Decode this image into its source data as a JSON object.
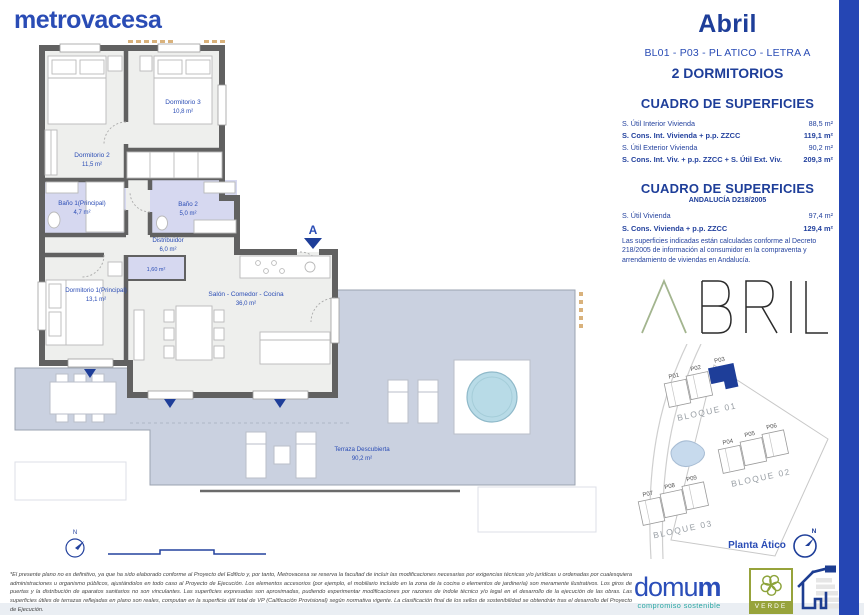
{
  "page": {
    "brand_logo": "metrovacesa",
    "title": "Abril",
    "unit_code": "BL01 - P03 - PL ATICO - LETRA A",
    "typology": "2 DORMITORIOS"
  },
  "surface_table": {
    "title": "CUADRO DE SUPERFICIES",
    "rows": [
      {
        "label": "S. Útil Interior Vivienda",
        "value": "88,5 m²"
      },
      {
        "label": "S. Cons. Int. Vivienda + p.p. ZZCC",
        "value": "119,1 m²"
      },
      {
        "label": "S. Útil Exterior Vivienda",
        "value": "90,2 m²"
      },
      {
        "label": "S. Cons. Int. Viv. + p.p. ZZCC + S. Útil Ext. Viv.",
        "value": "209,3 m²"
      }
    ]
  },
  "andalucia_table": {
    "title": "CUADRO DE SUPERFICIES",
    "subtitle": "ANDALUCÍA D218/2005",
    "rows": [
      {
        "label": "S. Útil Vivienda",
        "value": "97,4 m²"
      },
      {
        "label": "S. Cons. Vivienda + p.p. ZZCC",
        "value": "129,4 m²"
      }
    ],
    "note": "Las superficies indicadas están calculadas conforme al Decreto 218/2005 de información al consumidor en la compraventa y arrendamiento de viviendas en Andalucía."
  },
  "floorplan": {
    "north_label": "N",
    "section_label": "A",
    "rooms": {
      "dorm3": {
        "name": "Dormitorio 3",
        "area": "10,8 m²"
      },
      "dorm2": {
        "name": "Dormitorio 2",
        "area": "11,5 m²"
      },
      "bath1": {
        "name": "Baño 1(Principal)",
        "area": "4,7 m²"
      },
      "bath2": {
        "name": "Baño 2",
        "area": "5,0 m²"
      },
      "hall": {
        "name": "Distribuidor",
        "area": "6,0 m²"
      },
      "closet": {
        "area": "1,60 m²"
      },
      "dorm1": {
        "name": "Dormitorio 1(Principal)",
        "area": "13,1 m²"
      },
      "salon": {
        "name": "Salón - Comedor - Cocina",
        "area": "36,0 m²"
      },
      "terrace": {
        "name": "Terraza Descubierta",
        "area": "90,2 m²"
      }
    }
  },
  "siteplan": {
    "blocks": [
      "BLOQUE 01",
      "BLOQUE 02",
      "BLOQUE 03"
    ],
    "portals": [
      "P01",
      "P02",
      "P03",
      "P04",
      "P05",
      "P06",
      "P07",
      "P08",
      "P09"
    ],
    "highlighted_portal": "P03",
    "caption": "Planta Ático",
    "north_label": "N"
  },
  "footer": {
    "disclaimer": "*El presente plano no es definitivo, ya que ha sido elaborado conforme al Proyecto del Edificio y, por tanto, Metrovacesa se reserva la facultad de incluir las modificaciones necesarias por exigencias técnicas y/o jurídicas u ordenadas por cualesquiera administraciones u organismo públicos, ajustándolos en todo caso al Proyecto de Ejecución. Los elementos accesorios (por ejemplo, el mobiliario incluido en la zona de la cocina o elementos de jardinería) son meramente ilustrativos. Los giros de puertas y la distribución de aparatos sanitarios no son vinculantes. Las superficies expresadas son aproximadas, pudiendo experimentar modificaciones por razones de índole técnico y/o legal en el desarrollo de la ejecución de las obras. Las superficies útiles de terrazas reflejadas en plano son reales, computan en la superficie útil total de VP (Calificación Provisional) según normativa vigente. La clasificación final de los sellos de sostenibilidad se obtendrán tras el desarrollo del Proyecto de Ejecución.",
    "domum_head": "domu",
    "domum_tail": "m",
    "domum_tagline": "compromiso sostenible",
    "verde_label": "VERDE",
    "energy_rating": "A"
  },
  "colors": {
    "brand_blue": "#2a4cb5",
    "navy": "#1e3e99",
    "wall_gray": "#616161",
    "room_fill": "#eeefed",
    "bath_fill": "#d6d8f0",
    "terrace_fill": "#cad1e0",
    "pool_blue": "#b8dbe7",
    "verde_green": "#97a33b",
    "teal": "#2aa7a3"
  }
}
